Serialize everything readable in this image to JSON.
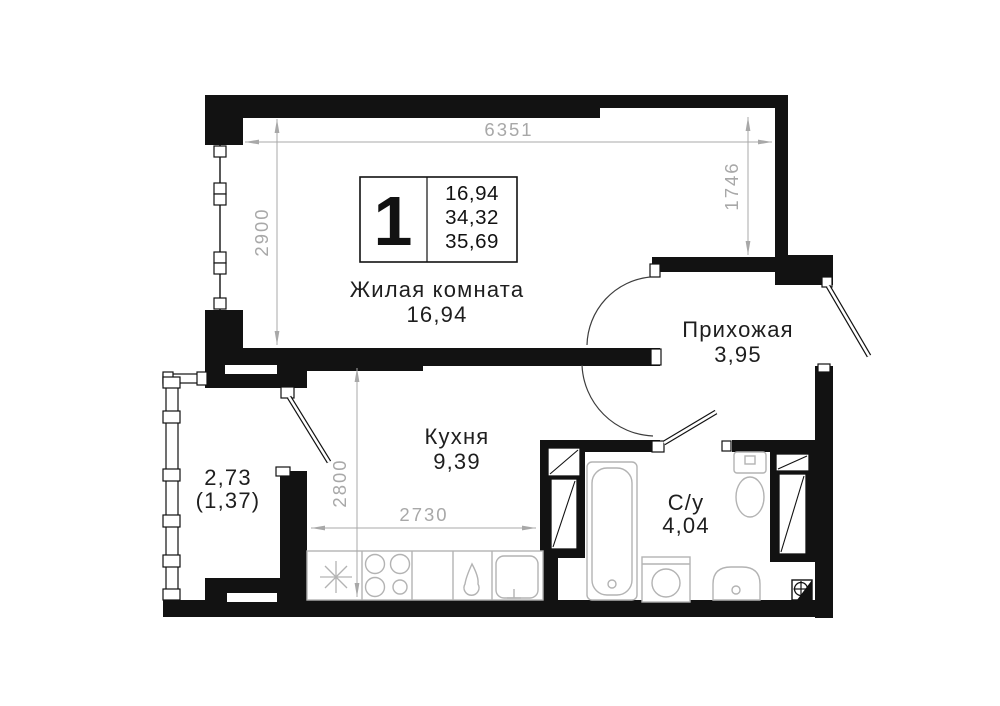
{
  "plan": {
    "title": "apartment-floor-plan",
    "info_box": {
      "rooms_count": "1",
      "area_living": "16,94",
      "area_mid": "34,32",
      "area_total": "35,69"
    },
    "rooms": {
      "living_room": {
        "name": "Жилая комната",
        "area": "16,94"
      },
      "kitchen": {
        "name": "Кухня",
        "area": "9,39"
      },
      "hallway": {
        "name": "Прихожая",
        "area": "3,95"
      },
      "bathroom": {
        "name": "С/у",
        "area": "4,04"
      },
      "balcony": {
        "area": "2,73",
        "area_reduced": "(1,37)"
      }
    },
    "dimensions": {
      "top_width": "6351",
      "living_height": "2900",
      "right_height": "1746",
      "kitchen_height": "2800",
      "kitchen_width": "2730"
    },
    "colors": {
      "wall": "#121212",
      "dimension": "#a8a8a8",
      "fixture": "#b3b3b3",
      "background": "#ffffff"
    }
  }
}
